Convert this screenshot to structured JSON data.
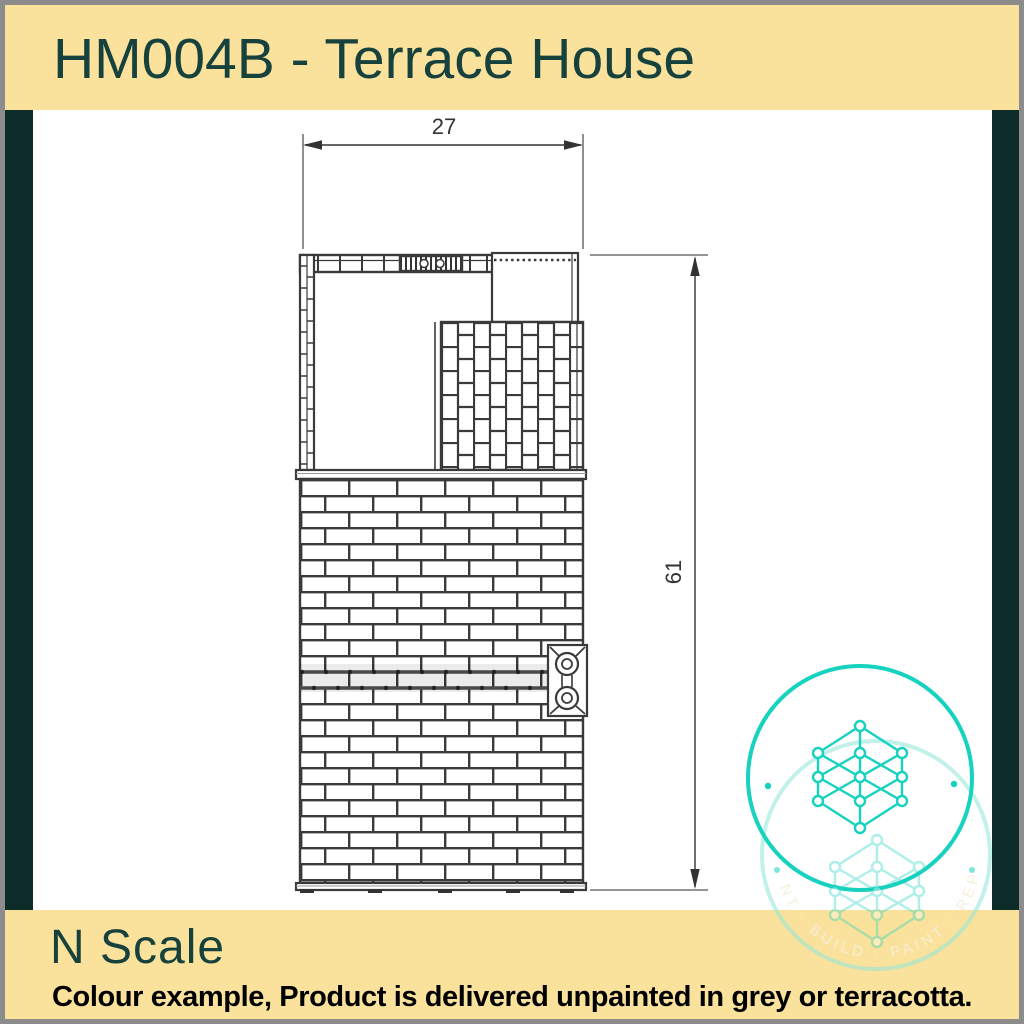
{
  "header": {
    "title": "HM004B - Terrace House"
  },
  "footer": {
    "scale": "N Scale",
    "note": "Colour example, Product is delivered unpainted in grey or terracotta."
  },
  "drawing": {
    "type": "technical-plan",
    "subject": "Terrace house roof-plan with brick walls, tiled yard, downpipe detail and base course",
    "dimensions": {
      "width": "27",
      "height": "61"
    }
  },
  "watermark": {
    "ring_text": "NT · BUILD · PAINT · REP"
  },
  "colors": {
    "banner_yellow": "#fae29c",
    "dark_teal_bar": "#0d2b29",
    "title_teal": "#17413d",
    "drawing_line": "#3a3a3a",
    "logo_teal": "#16d2be",
    "frame_gray": "#8c8c8c"
  }
}
